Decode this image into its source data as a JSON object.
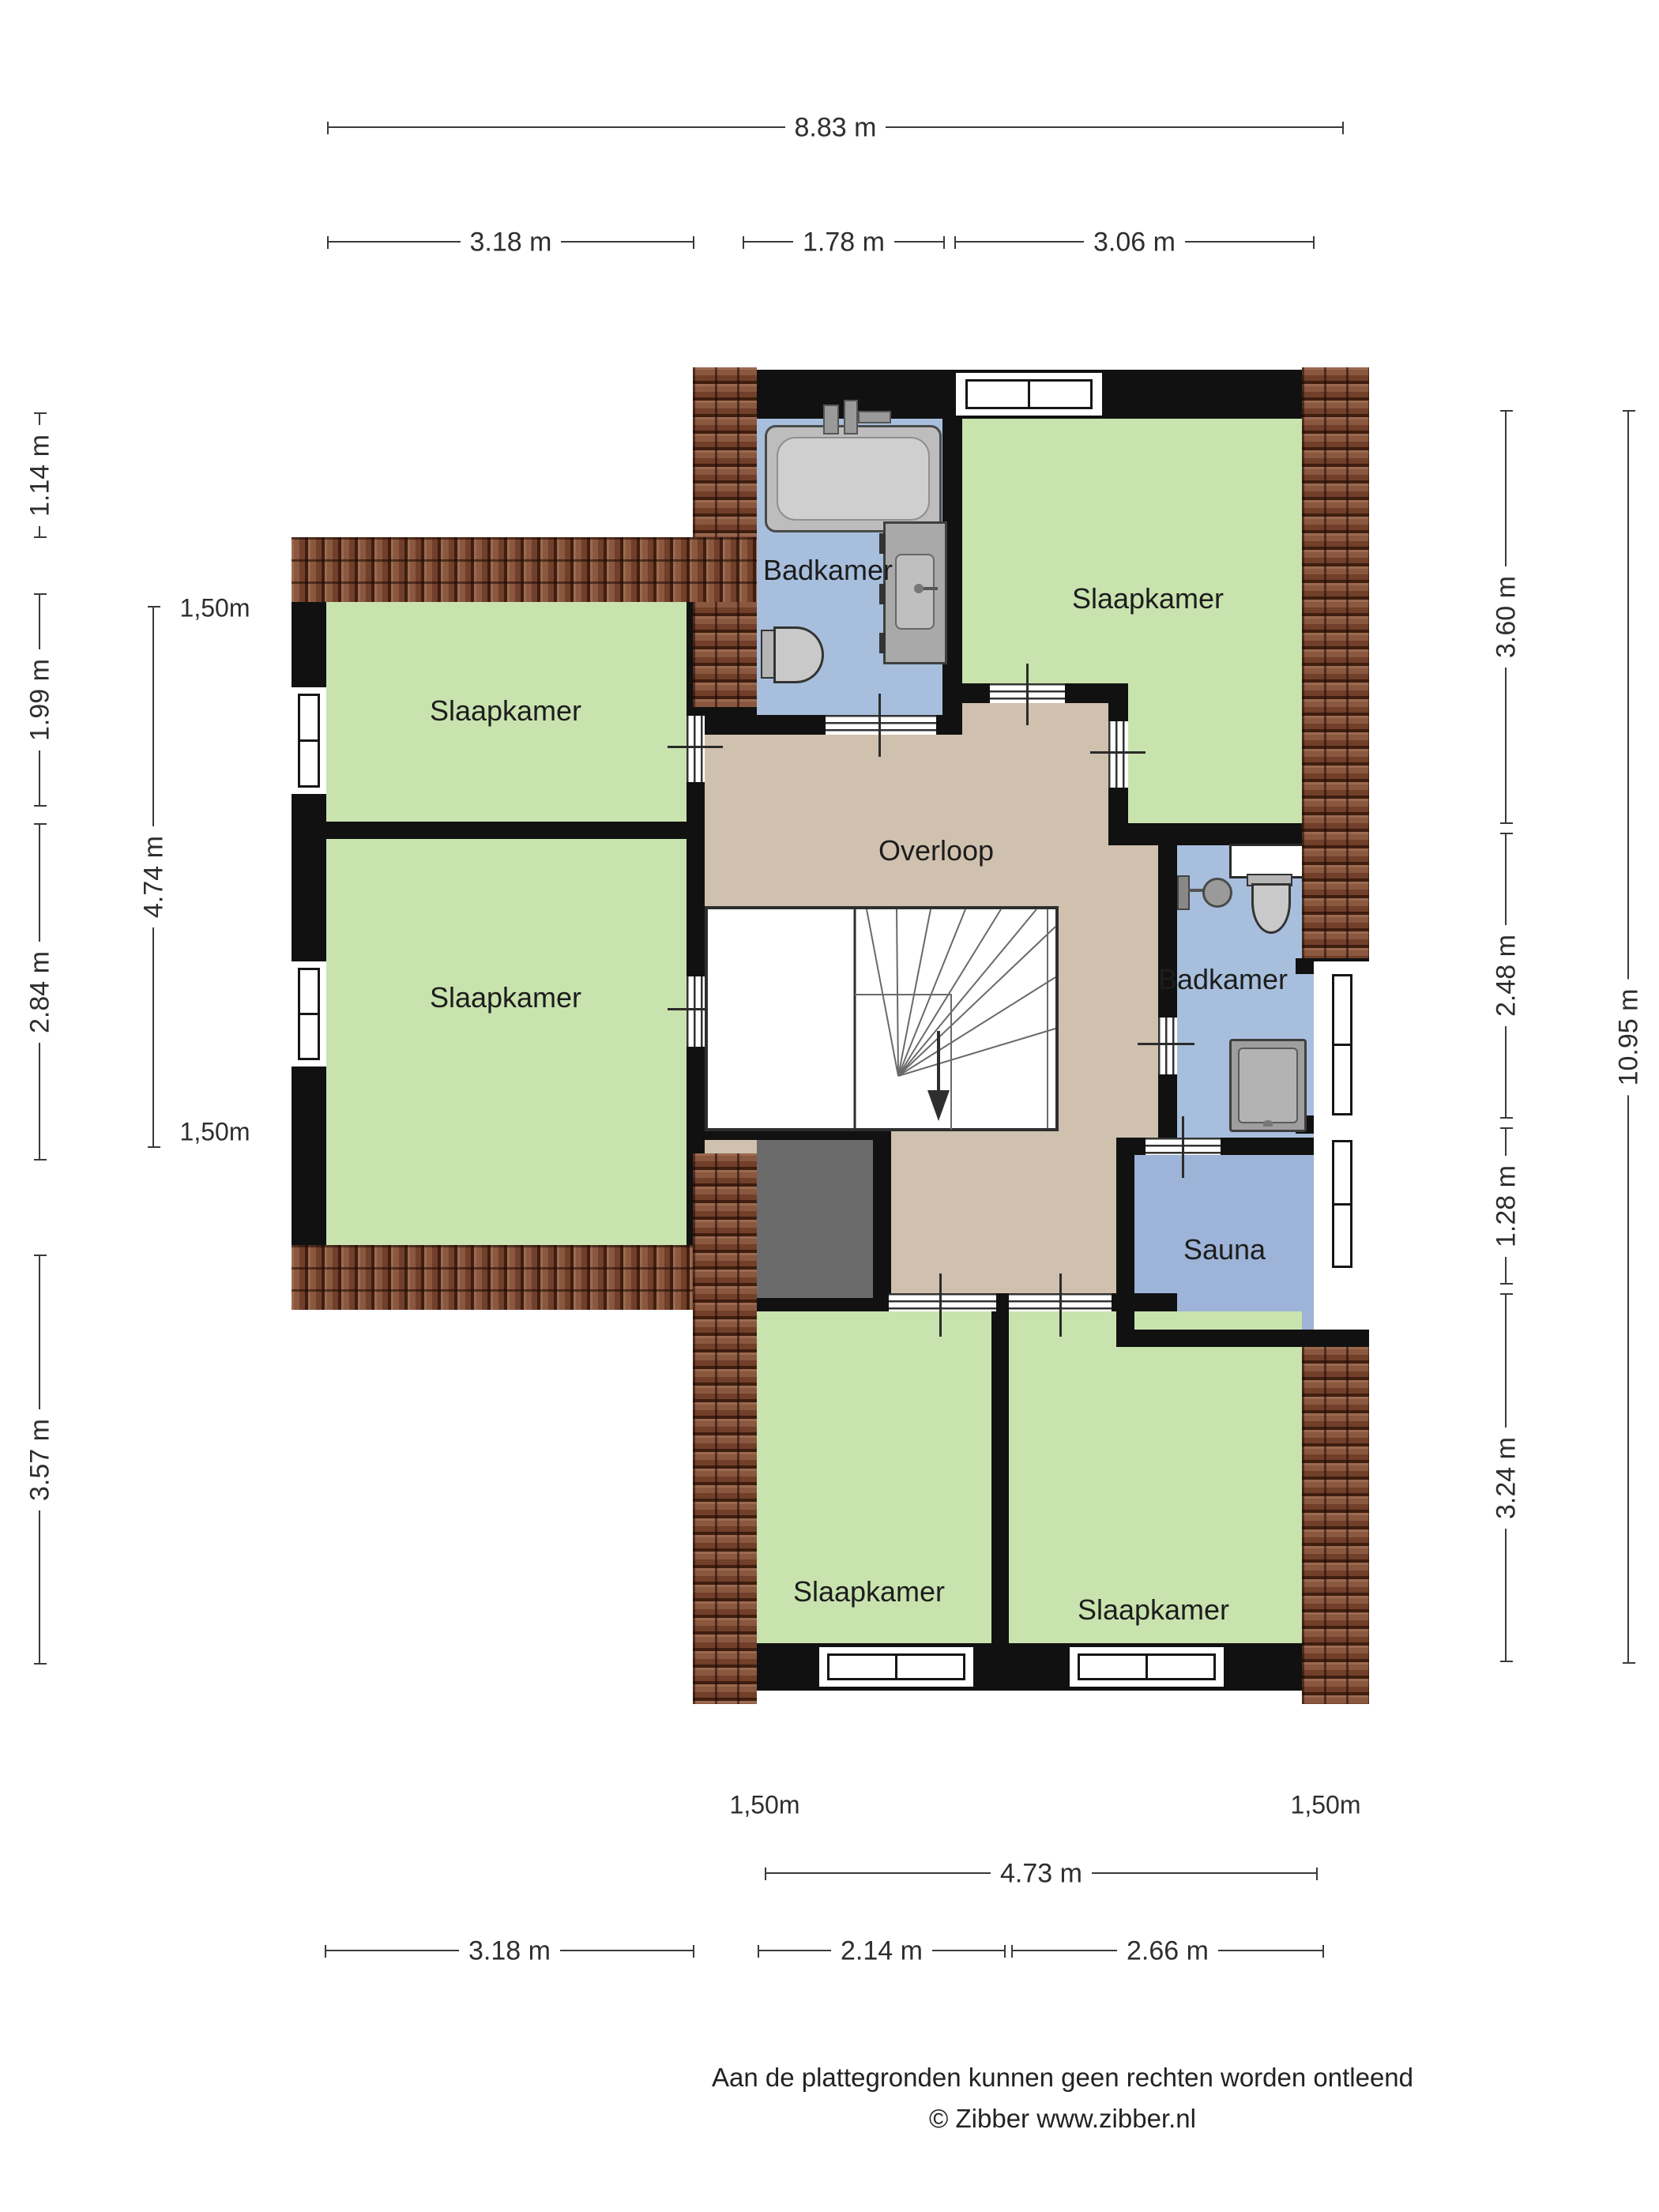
{
  "rooms": {
    "badkamer_top": "Badkamer",
    "slaapkamer_top_right": "Slaapkamer",
    "slaapkamer_left_1": "Slaapkamer",
    "slaapkamer_left_2": "Slaapkamer",
    "overloop": "Overloop",
    "badkamer_right": "Badkamer",
    "sauna": "Sauna",
    "slaapkamer_bottom_left": "Slaapkamer",
    "slaapkamer_bottom_right": "Slaapkamer"
  },
  "dimensions": {
    "top_total": "8.83 m",
    "top_a": "3.18 m",
    "top_b": "1.78 m",
    "top_c": "3.06 m",
    "left_a": "1.14 m",
    "left_b": "1.99 m",
    "left_c": "2.84 m",
    "left_d": "3.57 m",
    "left_inner": "4.74 m",
    "right_a": "3.60 m",
    "right_b": "2.48 m",
    "right_c": "1.28 m",
    "right_d": "3.24 m",
    "right_total": "10.95 m",
    "bottom_inner": "4.73 m",
    "bottom_a": "3.18 m",
    "bottom_b": "2.14 m",
    "bottom_c": "2.66 m"
  },
  "ceiling_labels": {
    "left_top": "1,50m",
    "left_bottom": "1,50m",
    "bottom_left": "1,50m",
    "bottom_right": "1,50m"
  },
  "footer": {
    "line1": "Aan de plattegronden kunnen geen rechten worden ontleend",
    "line2": "© Zibber www.zibber.nl"
  },
  "colors": {
    "room_green": "#c9e3ae",
    "bath_blue": "#a7bfdc",
    "sauna_blue": "#9db3d7",
    "hall_tan": "#cfc1ae",
    "wall_black": "#111111",
    "roof_brown": "#7d4b36",
    "attic_gray": "#6b6b6b"
  }
}
